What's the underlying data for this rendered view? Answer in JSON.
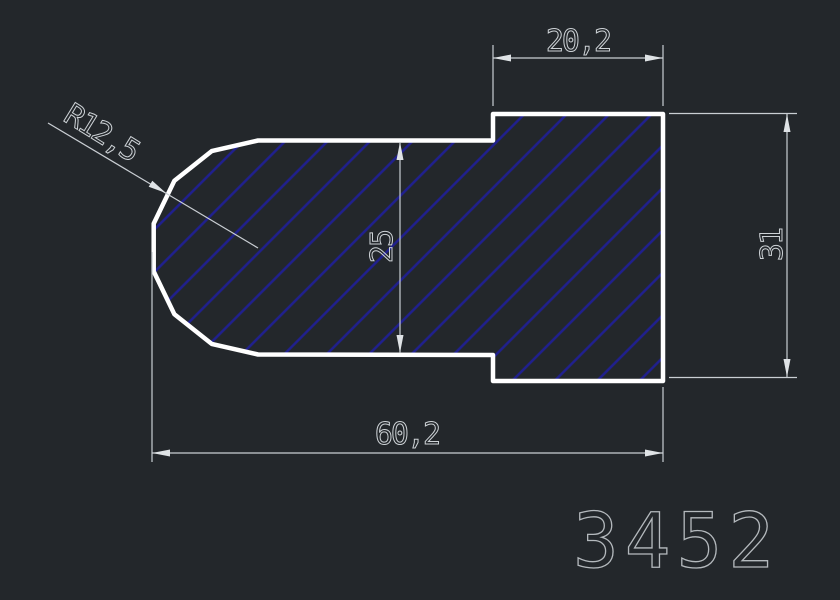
{
  "canvas": {
    "part_number": "3452",
    "dimensions": {
      "top_width": "20,2",
      "radius": "R12,5",
      "inner_height": "25",
      "right_height": "31",
      "total_width": "60,2"
    },
    "colors": {
      "background": "#23272b",
      "outline": "#ffffff",
      "hatch": "#20208f",
      "dimension_lines": "#cdd2d6",
      "part_number_text": "#b4b9bd"
    }
  }
}
